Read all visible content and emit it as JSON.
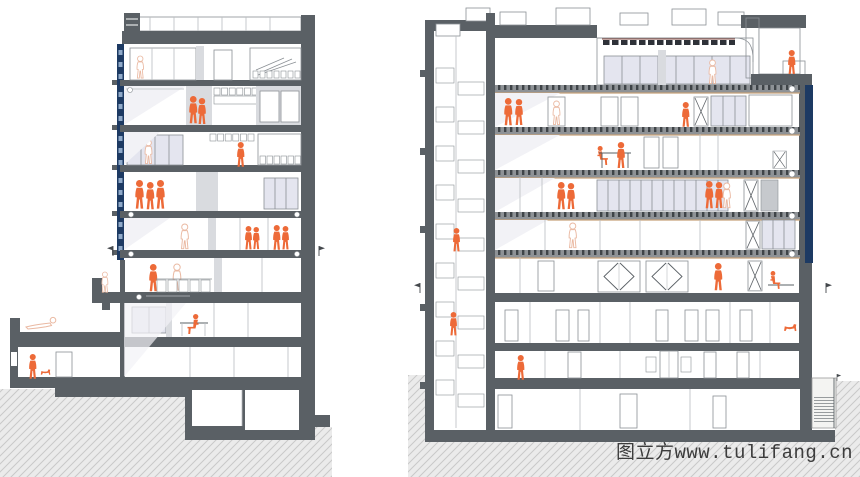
{
  "meta": {
    "type": "architectural-section-drawing",
    "views": 2
  },
  "watermark": {
    "text": "图立方www.tulifang.cn"
  },
  "palette": {
    "paper": "#ffffff",
    "accent": "#ed6a38",
    "pale_figure": "#eab9a2",
    "slab": "#5a6065",
    "frame": "#8b9095",
    "partition": "#b9bdc1",
    "glazing": "#e4e5ef",
    "shade": "#d9dbdf",
    "sheen": "#f2f2f6",
    "navy": "#1d3a63",
    "navy_light": "#8fa9c9",
    "teal": "#4f9097",
    "teal_bg": "#e4f0f1",
    "tan": "#d2a078",
    "tan_line": "#c8a27a",
    "deck": "#8e9296",
    "tick": "#3f4448",
    "panel_gray": "#c6c9cd",
    "ground_bg": "#ebebeb",
    "ground_line": "#c9c9c9",
    "watermark_color": "#3c3c3c"
  },
  "sections": {
    "left": {
      "name": "Left building section",
      "floors_above_ground": 8,
      "orange_figures": 13
    },
    "right": {
      "name": "Right building section",
      "floors_above_ground": 8,
      "orange_figures": 16
    }
  }
}
